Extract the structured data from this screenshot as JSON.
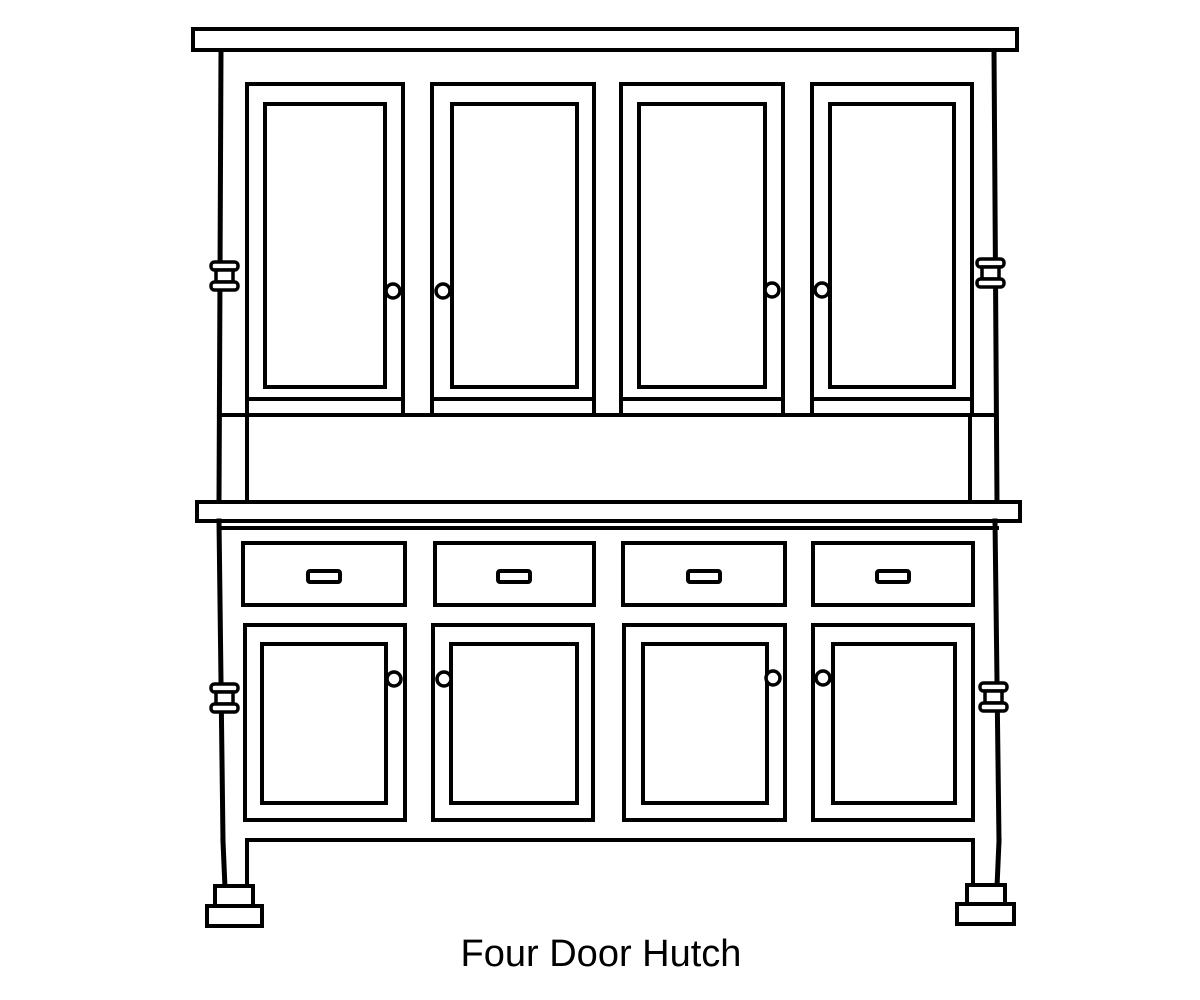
{
  "caption": {
    "text": "Four Door Hutch"
  },
  "illustration": {
    "subject": "black-and-white line drawing of a four door hutch cabinet",
    "style": {
      "line_color": "#000000",
      "background_color": "#ffffff",
      "text_color": "#000000"
    },
    "components": {
      "upper_doors": 4,
      "lower_doors": 4,
      "drawers": 4,
      "door_knobs": 8,
      "drawer_pulls": 4,
      "side_pegs": 4,
      "feet": 2,
      "parts": [
        "crown molding top board",
        "four upper cabinet doors with round knobs",
        "open shelf niche",
        "counter top board",
        "four drawers with rectangular pulls",
        "four lower cabinet doors with round knobs",
        "spool-shaped side pegs",
        "legs with stepped block feet"
      ]
    }
  }
}
